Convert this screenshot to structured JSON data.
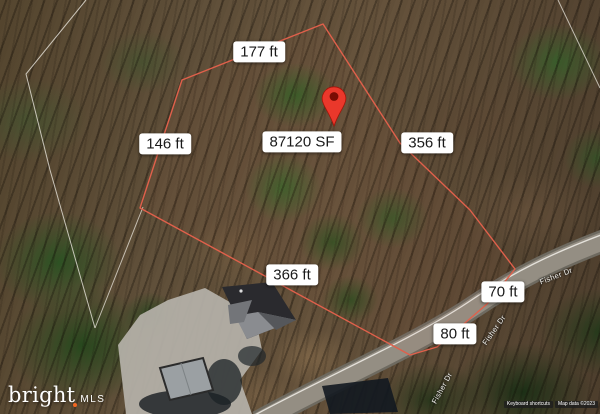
{
  "map": {
    "description": "Aerial satellite view of a wooded lot with surveyed boundary dimensions",
    "dimension_labels": {
      "top": "177 ft",
      "left": "146 ft",
      "area": "87120 SF",
      "right": "356 ft",
      "bottom": "366 ft",
      "frontage_upper": "70 ft",
      "frontage_lower": "80 ft"
    },
    "road": {
      "name": "Fisher Dr"
    },
    "marker": {
      "type": "location-pin",
      "color": "#EA382B"
    },
    "watermark": {
      "brand": "bright",
      "suffix": "MLS",
      "spark_color": "#F26722"
    },
    "attribution": {
      "keyboard": "Keyboard shortcuts",
      "map_data": "Map data ©2023"
    },
    "colors": {
      "boundary_line": "#E0604B",
      "parcel_line": "#E9E5DC",
      "label_bg": "#FFFFFF",
      "label_text": "#1A1A1A",
      "road_fill": "#948E83"
    }
  }
}
